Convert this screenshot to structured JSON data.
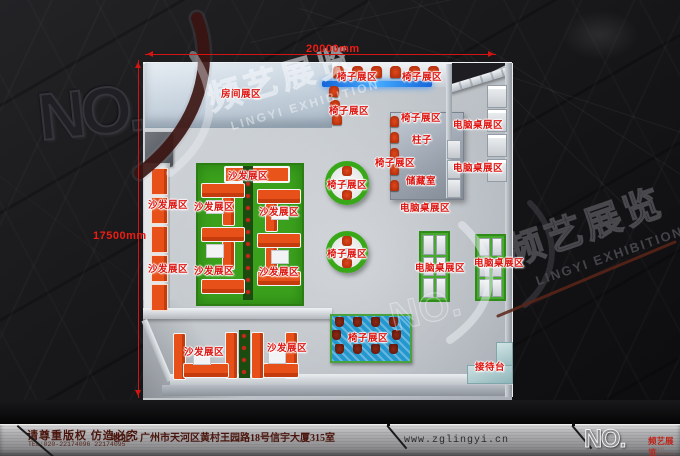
{
  "branding": {
    "no_label": "NO.",
    "cn": "频艺展览",
    "en": "LINGYI EXHIBITION"
  },
  "dimensions": {
    "top": "20000mm",
    "left": "17500mm"
  },
  "plan": {
    "area_labels": [
      {
        "text": "房间展区",
        "x": 241,
        "y": 93
      },
      {
        "text": "椅子展区",
        "x": 357,
        "y": 76
      },
      {
        "text": "椅子展区",
        "x": 422,
        "y": 76
      },
      {
        "text": "椅子展区",
        "x": 349,
        "y": 110
      },
      {
        "text": "椅子展区",
        "x": 421,
        "y": 117
      },
      {
        "text": "柱子",
        "x": 422,
        "y": 139
      },
      {
        "text": "椅子展区",
        "x": 395,
        "y": 162
      },
      {
        "text": "储藏室",
        "x": 421,
        "y": 180
      },
      {
        "text": "电脑桌展区",
        "x": 478,
        "y": 124
      },
      {
        "text": "电脑桌展区",
        "x": 478,
        "y": 167
      },
      {
        "text": "电脑桌展区",
        "x": 425,
        "y": 207
      },
      {
        "text": "电脑桌展区",
        "x": 440,
        "y": 267
      },
      {
        "text": "电脑桌展区",
        "x": 499,
        "y": 262
      },
      {
        "text": "椅子展区",
        "x": 347,
        "y": 184
      },
      {
        "text": "椅子展区",
        "x": 347,
        "y": 253
      },
      {
        "text": "沙发展区",
        "x": 248,
        "y": 175
      },
      {
        "text": "沙发展区",
        "x": 214,
        "y": 206
      },
      {
        "text": "沙发展区",
        "x": 279,
        "y": 211
      },
      {
        "text": "沙发展区",
        "x": 214,
        "y": 270
      },
      {
        "text": "沙发展区",
        "x": 279,
        "y": 271
      },
      {
        "text": "沙发展区",
        "x": 168,
        "y": 204
      },
      {
        "text": "沙发展区",
        "x": 168,
        "y": 268
      },
      {
        "text": "沙发展区",
        "x": 204,
        "y": 351
      },
      {
        "text": "沙发展区",
        "x": 287,
        "y": 347
      },
      {
        "text": "椅子展区",
        "x": 368,
        "y": 337
      },
      {
        "text": "接待台",
        "x": 490,
        "y": 366
      }
    ]
  },
  "footer": {
    "copyright": "请尊重版权 仿造必究",
    "tel": "TEL:020-22174096 22174095",
    "address": "地址：广州市天河区黄村王园路18号信宇大厦315室",
    "website": "www.zglingyi.cn"
  },
  "colors": {
    "label_red": "#dd1410",
    "dimension_red": "#ee1c12",
    "sofa_orange": "#e8501a",
    "mat_green": "#3ba11c",
    "mat_blue": "#2497cf",
    "logo_red": "#bf2318"
  }
}
